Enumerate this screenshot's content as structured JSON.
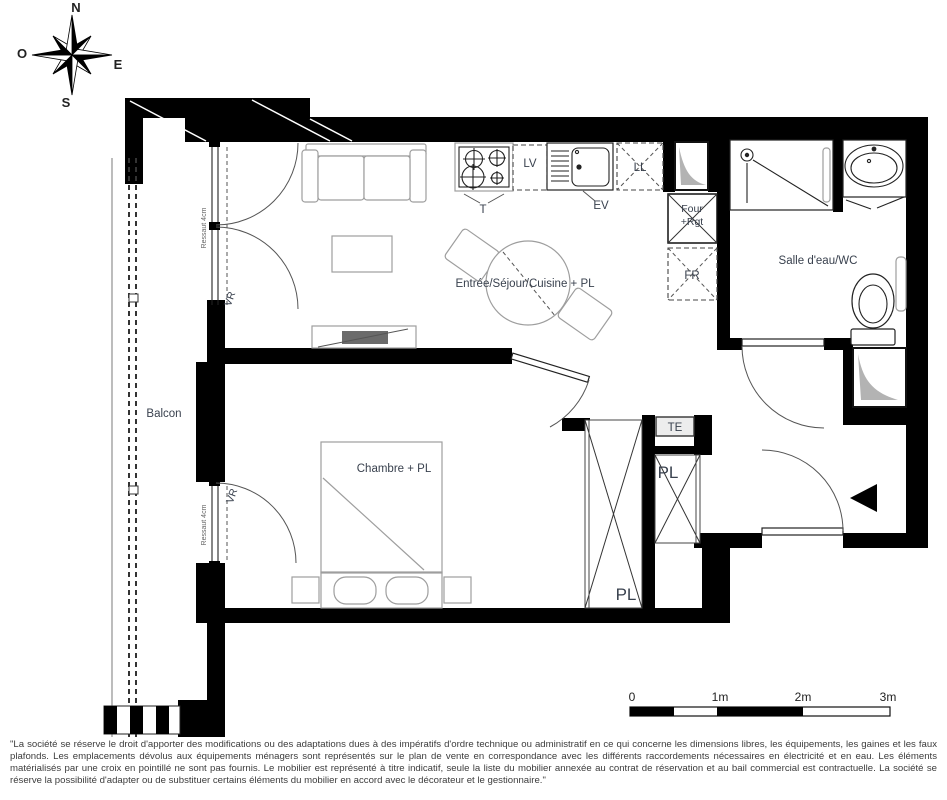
{
  "compass": {
    "n": "N",
    "w": "O",
    "e": "E",
    "s": "S"
  },
  "rooms": {
    "living": "Entrée/Séjour/Cuisine + PL",
    "bathroom": "Salle d'eau/WC",
    "bedroom": "Chambre + PL",
    "balcony": "Balcon"
  },
  "labels": {
    "hob": "T",
    "dishwasher": "LV",
    "sink": "EV",
    "washing_machine": "LL",
    "oven_line1": "Four",
    "oven_line2": "+Rgt",
    "fridge": "FR",
    "electrical_panel": "TE",
    "closet_hall": "PL",
    "closet_bedroom": "PL",
    "roller_shutter_living": "VR",
    "roller_shutter_bedroom": "VR",
    "step_living": "Ressaut 4cm",
    "step_bedroom": "Ressaut 4cm"
  },
  "scale_bar": {
    "labels": [
      "0",
      "1m",
      "2m",
      "3m"
    ]
  },
  "disclaimer": "\"La société se réserve le droit d'apporter des modifications ou des adaptations dues à des impératifs d'ordre technique ou administratif en ce qui concerne les dimensions libres, les équipements, les gaines et les faux plafonds. Les emplacements dévolus aux équipements ménagers sont représentés sur le plan de vente en correspondance avec les différents raccordements nécessaires en électricité et en eau. Les éléments matérialisés par une croix en pointillé ne sont pas fournis. Le mobilier est représenté à titre indicatif, seule la liste du mobilier annexée au contrat de réservation et au bail commercial est contractuelle. La société se réserve la possibilité d'adapter ou de substituer certains éléments du mobilier en accord avec le décorateur et le gestionnaire.\"",
  "colors": {
    "wall": "#000000",
    "label": "#39414e",
    "duct_fill": "#b3b3b3"
  }
}
